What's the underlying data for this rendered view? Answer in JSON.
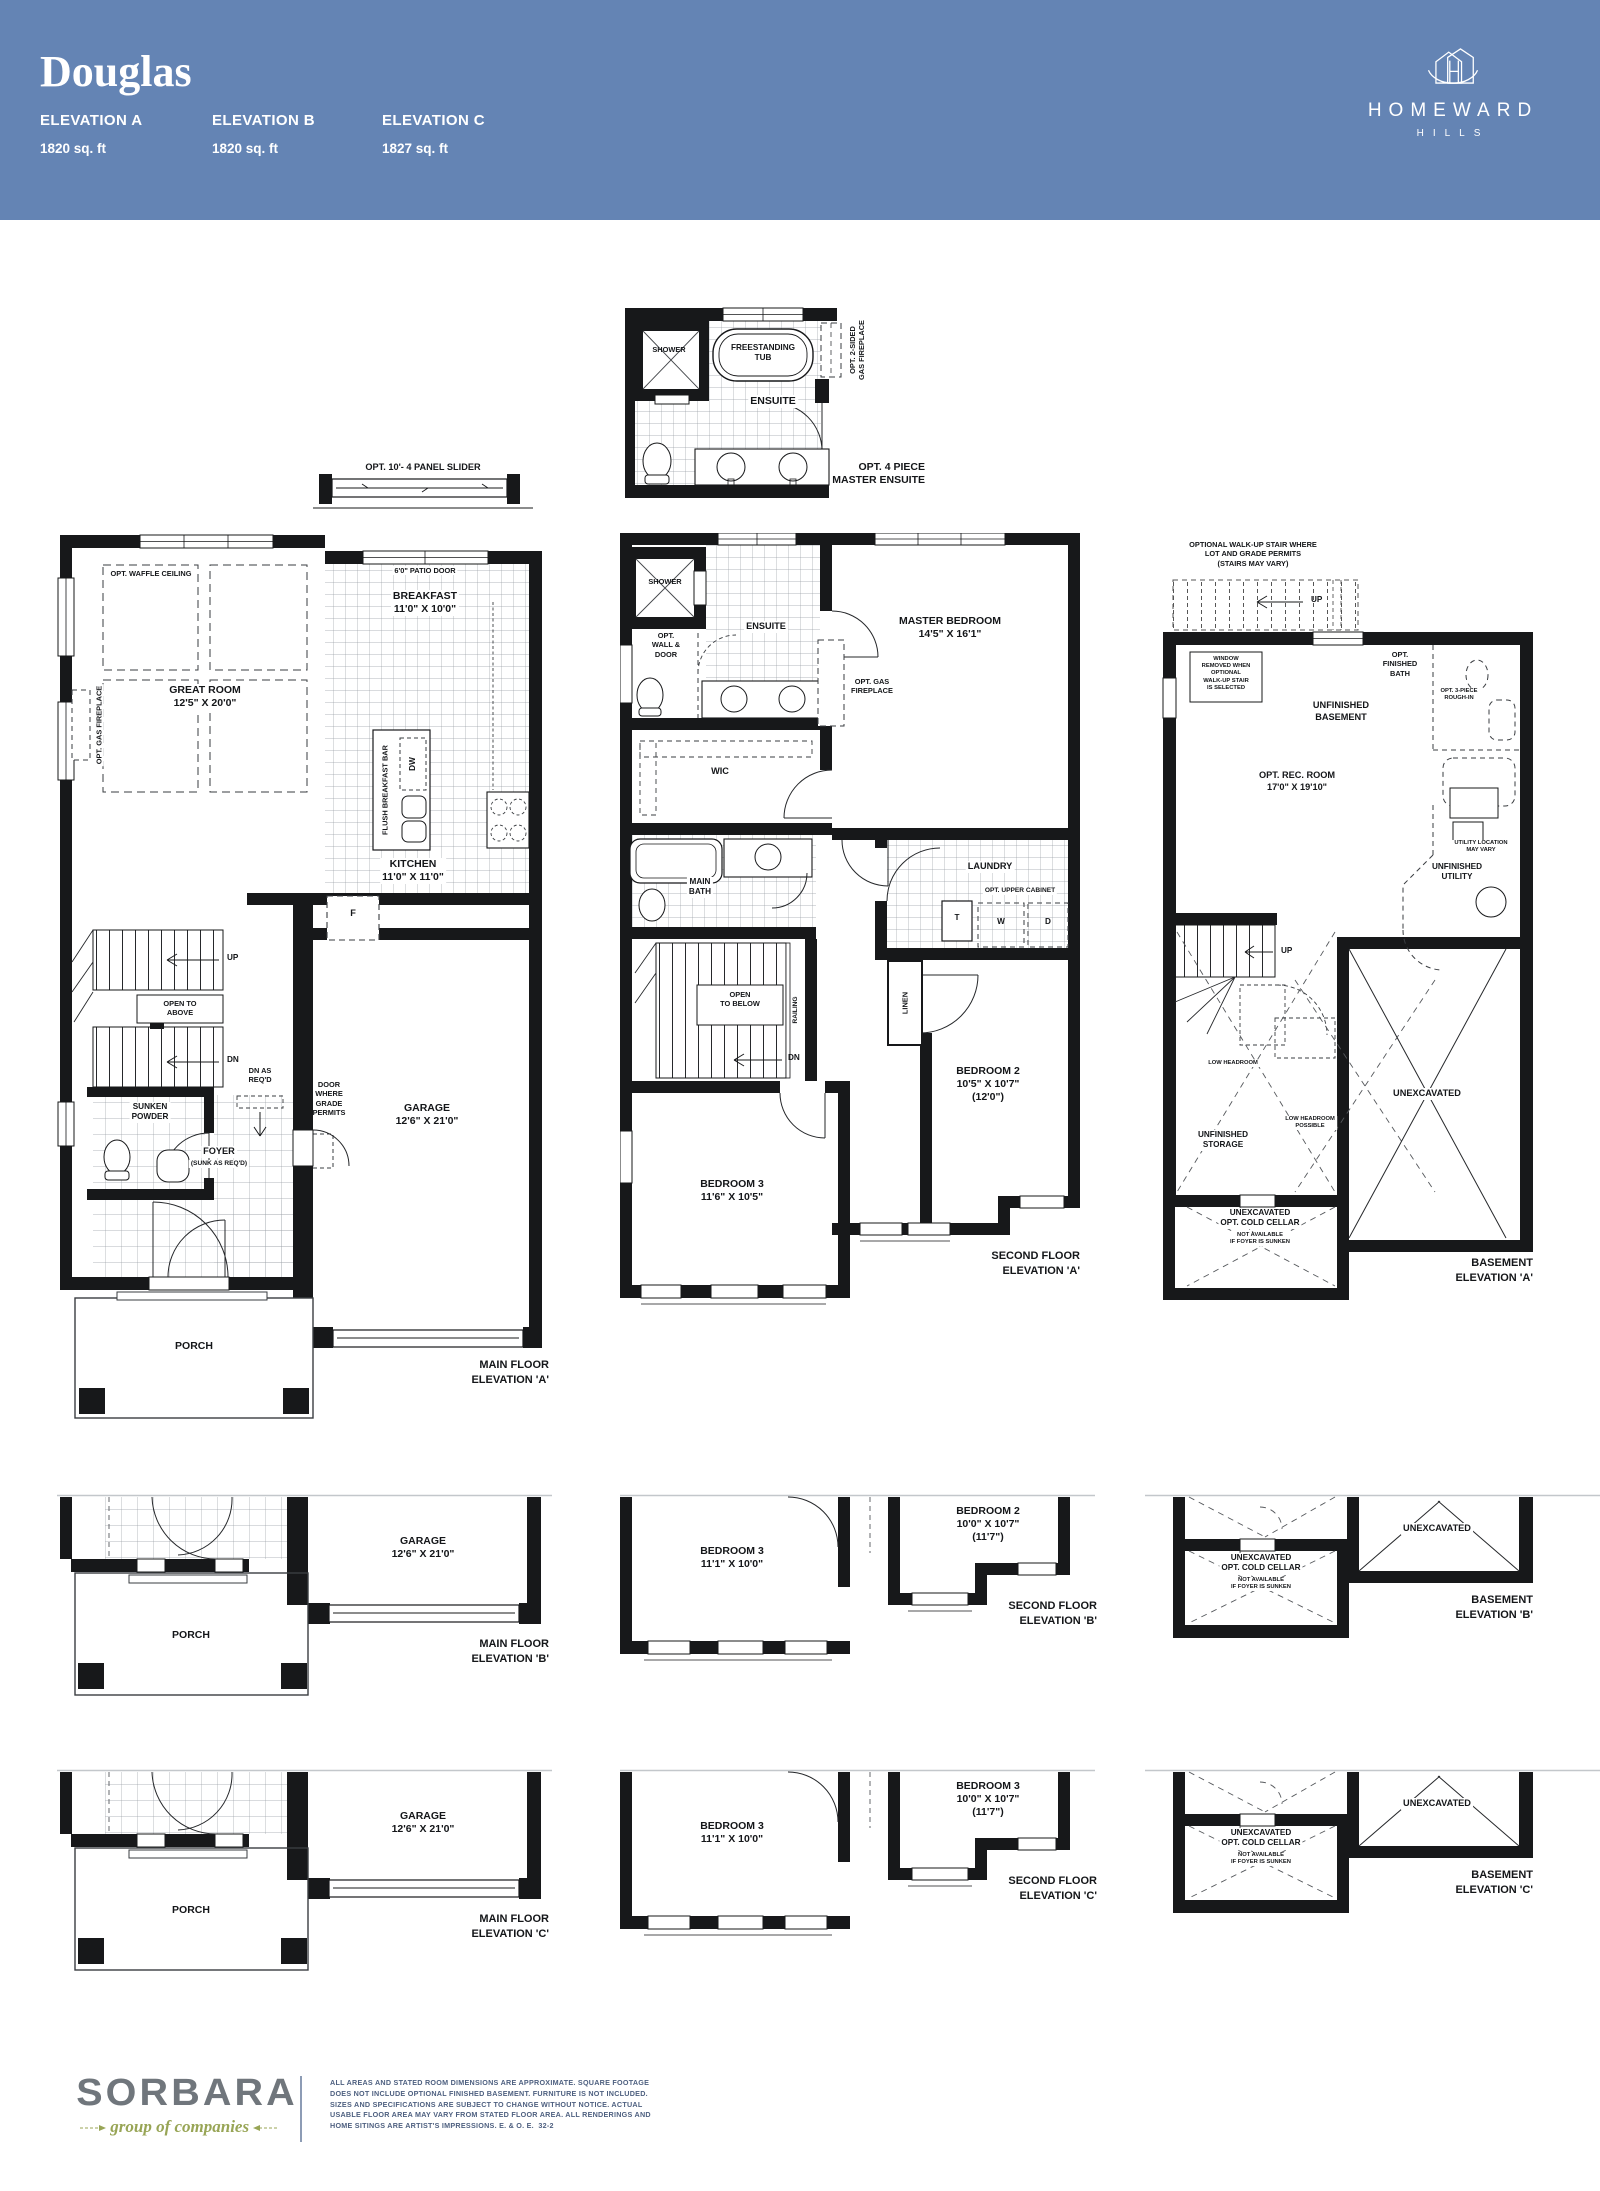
{
  "header": {
    "title": "Douglas",
    "band_color": "#6484b4",
    "elevations": [
      {
        "name": "ELEVATION A",
        "sqft": "1820 sq. ft"
      },
      {
        "name": "ELEVATION B",
        "sqft": "1820 sq. ft"
      },
      {
        "name": "ELEVATION C",
        "sqft": "1827 sq. ft"
      }
    ],
    "brand": {
      "name": "HOMEWARD",
      "sub": "HILLS"
    }
  },
  "ensuite_detail": {
    "shower": "SHOWER",
    "tub": "FREESTANDING\nTUB",
    "room": "ENSUITE",
    "fireplace": "OPT. 2-SIDED\nGAS FIREPLACE",
    "caption": "OPT. 4 PIECE\nMASTER ENSUITE"
  },
  "main_floor_a": {
    "slider": "OPT. 10'- 4 PANEL SLIDER",
    "patio_door": "6'0\" PATIO DOOR",
    "waffle": "OPT. WAFFLE CEILING",
    "great_room": "GREAT ROOM\n12'5\" X 20'0\"",
    "gas_fireplace": "OPT. GAS FIREPLACE",
    "breakfast": "BREAKFAST\n11'0\" X 10'0\"",
    "breakfast_bar": "FLUSH BREAKFAST BAR",
    "dw": "DW",
    "kitchen": "KITCHEN\n11'0\" X 11'0\"",
    "fridge": "F",
    "up": "UP",
    "open_above": "OPEN TO\nABOVE",
    "dn": "DN",
    "dn_req": "DN AS\nREQ'D",
    "door_grade": "DOOR\nWHERE\nGRADE\nPERMITS",
    "powder": "SUNKEN\nPOWDER",
    "foyer": "FOYER",
    "foyer_sub": "(SUNK AS REQ'D)",
    "garage": "GARAGE\n12'6\" X 21'0\"",
    "porch": "PORCH",
    "caption": "MAIN FLOOR\nELEVATION 'A'"
  },
  "second_floor_a": {
    "shower": "SHOWER",
    "ensuite": "ENSUITE",
    "opt_wall": "OPT.\nWALL &\nDOOR",
    "master": "MASTER BEDROOM\n14'5\" X 16'1\"",
    "gas_fireplace": "OPT. GAS\nFIREPLACE",
    "wic": "WIC",
    "main_bath": "MAIN\nBATH",
    "laundry": "LAUNDRY",
    "upper_cabinet": "OPT. UPPER CABINET",
    "washer": "W",
    "dryer": "D",
    "tub": "T",
    "linen": "LINEN",
    "railing": "RAILING",
    "open_below": "OPEN\nTO BELOW",
    "dn": "DN",
    "bedroom2": "BEDROOM 2\n10'5\" X 10'7\"\n(12'0\")",
    "bedroom3": "BEDROOM 3\n11'6\" X 10'5\"",
    "caption": "SECOND FLOOR\nELEVATION 'A'"
  },
  "basement_a": {
    "walkup": "OPTIONAL WALK-UP STAIR WHERE\nLOT AND GRADE PERMITS\n(STAIRS MAY VARY)",
    "up_top": "UP",
    "window_note": "WINDOW\nREMOVED WHEN\nOPTIONAL\nWALK-UP STAIR\nIS SELECTED",
    "finished_bath": "OPT.\nFINISHED\nBATH",
    "rough_in": "OPT. 3-PIECE\nROUGH-IN",
    "unfinished_basement": "UNFINISHED\nBASEMENT",
    "rec_room": "OPT. REC. ROOM\n17'0\" X 19'10\"",
    "utility_loc": "UTILITY LOCATION\nMAY VARY",
    "unfinished_utility": "UNFINISHED\nUTILITY",
    "up_bottom": "UP",
    "low_headroom": "LOW HEADROOM",
    "low_possible": "LOW HEADROOM\nPOSSIBLE",
    "storage": "UNFINISHED\nSTORAGE",
    "unexcavated": "UNEXCAVATED",
    "cold_cellar": "UNEXCAVATED\nOPT. COLD CELLAR",
    "cold_cellar_note": "NOT AVAILABLE\nIF FOYER IS SUNKEN",
    "caption": "BASEMENT\nELEVATION 'A'"
  },
  "main_floor_b": {
    "garage": "GARAGE\n12'6\" X 21'0\"",
    "porch": "PORCH",
    "caption": "MAIN FLOOR\nELEVATION 'B'"
  },
  "second_floor_b": {
    "bedroom3": "BEDROOM 3\n11'1\" X 10'0\"",
    "bedroom2": "BEDROOM 2\n10'0\" X 10'7\"\n(11'7\")",
    "caption": "SECOND FLOOR\nELEVATION 'B'"
  },
  "basement_b": {
    "unexcavated": "UNEXCAVATED",
    "cold_cellar": "UNEXCAVATED\nOPT. COLD CELLAR",
    "cold_cellar_note": "NOT AVAILABLE\nIF FOYER IS SUNKEN",
    "caption": "BASEMENT\nELEVATION 'B'"
  },
  "main_floor_c": {
    "garage": "GARAGE\n12'6\" X 21'0\"",
    "porch": "PORCH",
    "caption": "MAIN FLOOR\nELEVATION 'C'"
  },
  "second_floor_c": {
    "bedroom3": "BEDROOM 3\n11'1\" X 10'0\"",
    "bedroom3b": "BEDROOM 3\n10'0\" X 10'7\"\n(11'7\")",
    "caption": "SECOND FLOOR\nELEVATION 'C'"
  },
  "basement_c": {
    "unexcavated": "UNEXCAVATED",
    "cold_cellar": "UNEXCAVATED\nOPT. COLD CELLAR",
    "cold_cellar_note": "NOT AVAILABLE\nIF FOYER IS SUNKEN",
    "caption": "BASEMENT\nELEVATION 'C'"
  },
  "footer": {
    "brand": "SORBARA",
    "tagline": "group of companies",
    "disclaimer": "ALL AREAS AND STATED ROOM DIMENSIONS ARE APPROXIMATE. SQUARE FOOTAGE\nDOES NOT INCLUDE OPTIONAL FINISHED BASEMENT. FURNITURE IS NOT INCLUDED.\nSIZES AND SPECIFICATIONS ARE SUBJECT TO CHANGE WITHOUT NOTICE. ACTUAL\nUSABLE FLOOR AREA MAY VARY FROM STATED FLOOR AREA. ALL RENDERINGS AND\nHOME SITINGS ARE ARTIST'S IMPRESSIONS. E. & O. E.  32-2"
  }
}
